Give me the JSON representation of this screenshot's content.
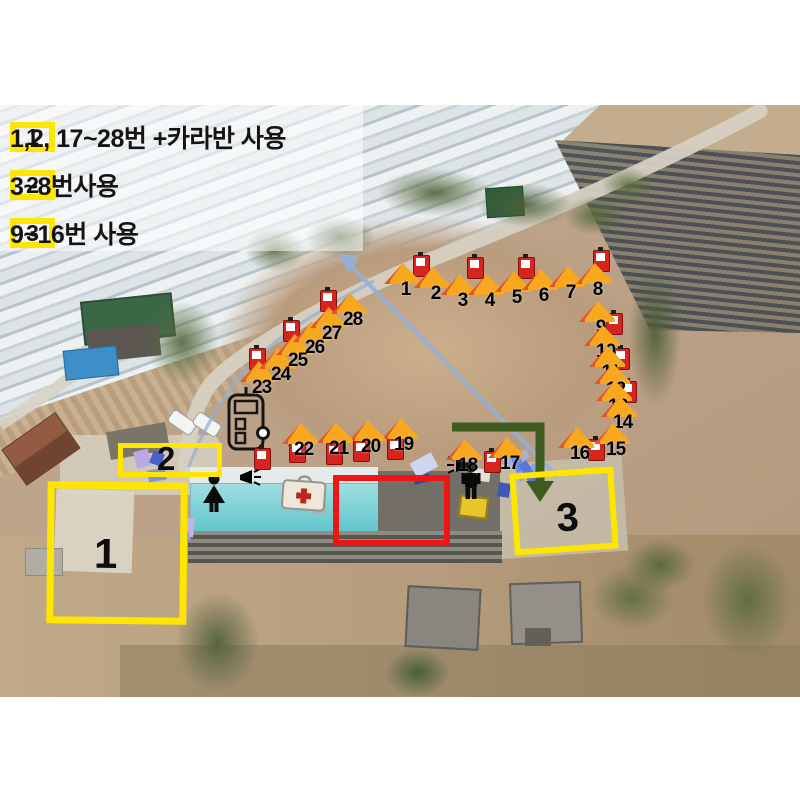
{
  "title": "campsite-zone-assignment-aerial-map",
  "colors": {
    "highlight_yellow": "#ffe600",
    "highlight_red": "#ee1515",
    "tent_orange": "#f7a81f",
    "tent_flap": "#e2562a",
    "extinguisher_red": "#d6251e",
    "route_blue": "#8fb2da",
    "path_green": "#3e5c20",
    "pool_cyan": "#58c3c9"
  },
  "legend": {
    "items": [
      {
        "zone": "1",
        "label": "1,2, 17~28번 +카라반 사용"
      },
      {
        "zone": "2",
        "label": "3~8번사용"
      },
      {
        "zone": "3",
        "label": "9~16번 사용"
      }
    ]
  },
  "zones": {
    "z1": {
      "label": "1"
    },
    "z2": {
      "label": "2"
    },
    "z3": {
      "label": "3"
    }
  },
  "markers": {
    "tents": [
      {
        "n": "1",
        "x": 388,
        "y": 158
      },
      {
        "n": "2",
        "x": 418,
        "y": 162
      },
      {
        "n": "3",
        "x": 445,
        "y": 169
      },
      {
        "n": "4",
        "x": 472,
        "y": 169
      },
      {
        "n": "5",
        "x": 499,
        "y": 166
      },
      {
        "n": "6",
        "x": 526,
        "y": 164
      },
      {
        "n": "7",
        "x": 553,
        "y": 161
      },
      {
        "n": "8",
        "x": 580,
        "y": 158
      },
      {
        "n": "9",
        "x": 583,
        "y": 196
      },
      {
        "n": "10",
        "x": 588,
        "y": 220
      },
      {
        "n": "11",
        "x": 593,
        "y": 241
      },
      {
        "n": "12",
        "x": 598,
        "y": 258
      },
      {
        "n": "13",
        "x": 600,
        "y": 275
      },
      {
        "n": "14",
        "x": 605,
        "y": 291
      },
      {
        "n": "15",
        "x": 598,
        "y": 318
      },
      {
        "n": "16",
        "x": 562,
        "y": 322
      },
      {
        "n": "17",
        "x": 492,
        "y": 332
      },
      {
        "n": "18",
        "x": 450,
        "y": 334
      },
      {
        "n": "19",
        "x": 386,
        "y": 313
      },
      {
        "n": "20",
        "x": 353,
        "y": 315
      },
      {
        "n": "21",
        "x": 321,
        "y": 317
      },
      {
        "n": "22",
        "x": 286,
        "y": 318
      },
      {
        "n": "23",
        "x": 244,
        "y": 256
      },
      {
        "n": "24",
        "x": 263,
        "y": 243
      },
      {
        "n": "25",
        "x": 280,
        "y": 229
      },
      {
        "n": "26",
        "x": 297,
        "y": 216
      },
      {
        "n": "27",
        "x": 314,
        "y": 202
      },
      {
        "n": "28",
        "x": 335,
        "y": 188
      }
    ],
    "extinguishers": [
      {
        "x": 413,
        "y": 150
      },
      {
        "x": 467,
        "y": 152
      },
      {
        "x": 518,
        "y": 152
      },
      {
        "x": 593,
        "y": 145
      },
      {
        "x": 606,
        "y": 208
      },
      {
        "x": 613,
        "y": 243
      },
      {
        "x": 620,
        "y": 276
      },
      {
        "x": 588,
        "y": 334
      },
      {
        "x": 484,
        "y": 346
      },
      {
        "x": 249,
        "y": 243
      },
      {
        "x": 283,
        "y": 215
      },
      {
        "x": 320,
        "y": 185
      },
      {
        "x": 254,
        "y": 343
      },
      {
        "x": 289,
        "y": 336
      },
      {
        "x": 326,
        "y": 338
      },
      {
        "x": 353,
        "y": 335
      },
      {
        "x": 387,
        "y": 333
      }
    ],
    "trees": [
      {
        "x": 370,
        "y": 60,
        "w": 130,
        "h": 55,
        "c": "#55663c"
      },
      {
        "x": 470,
        "y": 75,
        "w": 110,
        "h": 50,
        "c": "#4d5f38"
      },
      {
        "x": 560,
        "y": 88,
        "w": 70,
        "h": 45,
        "c": "#556b3e"
      },
      {
        "x": 598,
        "y": 60,
        "w": 60,
        "h": 40,
        "c": "#5d7044"
      },
      {
        "x": 625,
        "y": 150,
        "w": 60,
        "h": 160,
        "c": "#4f6038"
      },
      {
        "x": 140,
        "y": 190,
        "w": 85,
        "h": 95,
        "c": "#566b3f"
      },
      {
        "x": 240,
        "y": 120,
        "w": 70,
        "h": 50,
        "c": "#5e7245"
      },
      {
        "x": 300,
        "y": 108,
        "w": 80,
        "h": 48,
        "c": "#50623a"
      },
      {
        "x": 695,
        "y": 430,
        "w": 105,
        "h": 130,
        "c": "#5a6b40"
      },
      {
        "x": 170,
        "y": 480,
        "w": 95,
        "h": 115,
        "c": "#4f5f3a"
      },
      {
        "x": 380,
        "y": 540,
        "w": 75,
        "h": 55,
        "c": "#3f5c33"
      },
      {
        "x": 585,
        "y": 455,
        "w": 95,
        "h": 75,
        "c": "#5c6d41"
      },
      {
        "x": 620,
        "y": 430,
        "w": 80,
        "h": 60,
        "c": "#546539"
      }
    ],
    "deco": [
      {
        "x": 135,
        "y": 345,
        "w": 15,
        "h": 17,
        "c": "#b9a8e4",
        "r": -15
      },
      {
        "x": 151,
        "y": 347,
        "w": 12,
        "h": 13,
        "c": "#4a5fc8",
        "r": 20
      },
      {
        "x": 148,
        "y": 364,
        "w": 18,
        "h": 12,
        "c": "#7f95d8",
        "r": -10
      },
      {
        "x": 183,
        "y": 413,
        "w": 11,
        "h": 19,
        "c": "#c3b4e8",
        "r": 5
      },
      {
        "x": 178,
        "y": 428,
        "w": 12,
        "h": 9,
        "c": "#8fa0dc",
        "r": -20
      },
      {
        "x": 412,
        "y": 352,
        "w": 24,
        "h": 16,
        "c": "#cdd6ee",
        "r": -28
      },
      {
        "x": 414,
        "y": 370,
        "w": 16,
        "h": 8,
        "c": "#2e4a9e",
        "r": -15
      },
      {
        "x": 503,
        "y": 349,
        "w": 26,
        "h": 9,
        "c": "#9fb0ea",
        "r": -22
      },
      {
        "x": 512,
        "y": 342,
        "w": 9,
        "h": 26,
        "c": "#6e86e0",
        "r": -22
      },
      {
        "x": 516,
        "y": 362,
        "w": 26,
        "h": 9,
        "c": "#8ea2e6",
        "r": -30
      },
      {
        "x": 524,
        "y": 356,
        "w": 9,
        "h": 24,
        "c": "#5a74d8",
        "r": -30
      },
      {
        "x": 498,
        "y": 378,
        "w": 12,
        "h": 14,
        "c": "#3f57b4",
        "r": 10
      }
    ]
  }
}
